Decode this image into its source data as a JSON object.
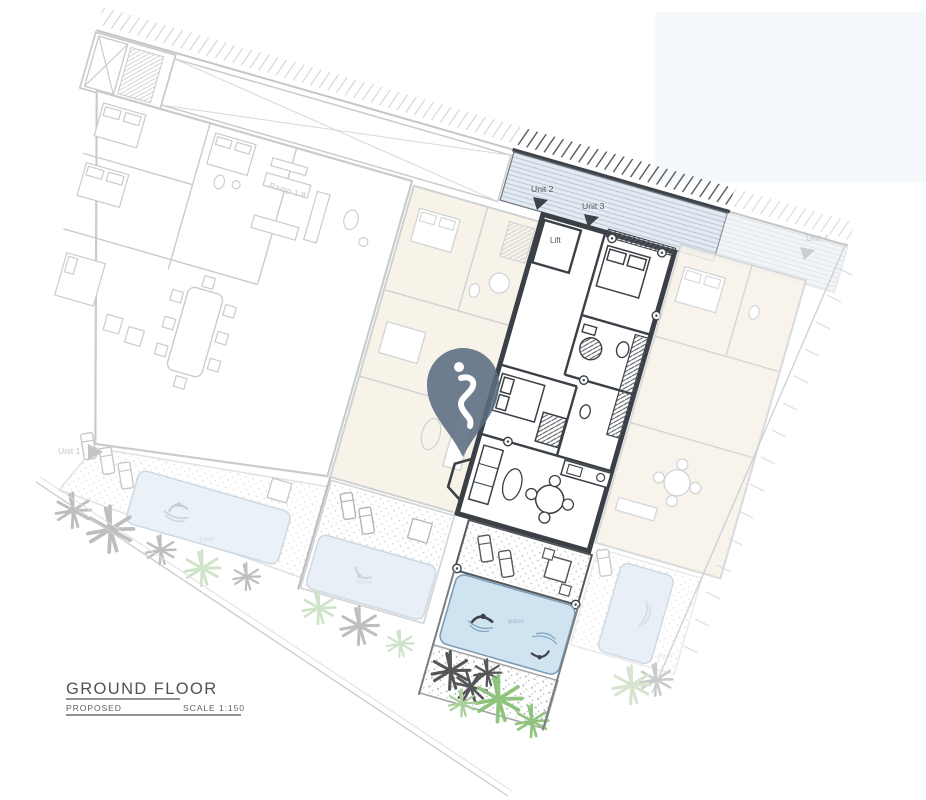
{
  "title_block": {
    "title": "GROUND FLOOR",
    "status": "PROPOSED",
    "scale": "SCALE 1:150"
  },
  "unit_labels": {
    "unit1": "Unit 1",
    "unit2": "Unit 2",
    "unit3": "Unit 3",
    "unit4": "Unit 4"
  },
  "room_labels": {
    "lift": "Lift",
    "ramp": "Ramp 1:8"
  },
  "pool_labels": {
    "pool1": "pool",
    "pool2": "pool",
    "pool3": "pool",
    "pool4": "pool"
  },
  "marker": {
    "icon": "location-pin-icon",
    "color": "#5a6c7f"
  },
  "colors": {
    "highlight_wall": "#3b4046",
    "faded_line": "#c9cbcd",
    "beige_fill": "#f7f3e9",
    "pool_blue": "#cfe3f1",
    "pool_blue_faded": "#e9eff6",
    "band_blue": "#e3eaf1",
    "band_stripe": "#bac8d6",
    "plant_green": "#8fc47e",
    "plant_gray": "#bcbec0",
    "pin": "#5a6c7f"
  }
}
